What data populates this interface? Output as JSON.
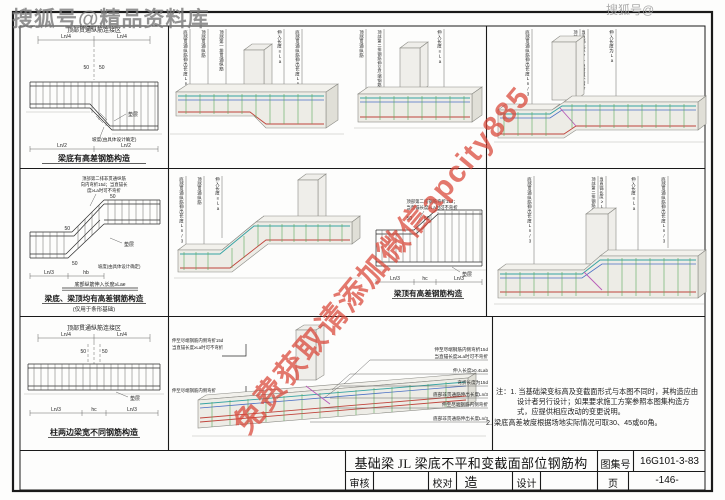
{
  "watermarks": {
    "top_left": "搜狐号@精品资料库",
    "top_right": "搜狐号@",
    "diagonal": "免费获取请添加微信apcity885"
  },
  "title_block": {
    "title": "基础梁 JL 梁底不平和变截面部位钢筋构造",
    "atlas_label": "图集号",
    "atlas_no": "16G101-3-83",
    "review_label": "审核",
    "check_label": "校对",
    "design_label": "设计",
    "page_label": "页",
    "page_no": "-146-"
  },
  "notes": {
    "prefix": "注：",
    "item1": "1. 当基础梁变标高及变截面形式与本图不同时，其构造应由设计者另行设计；如果要求施工方案参照本图集构造方式，应提供相应改动的变更说明。",
    "item2": "2. 梁底高差坡度根据场地实际情况可取30、45或60角。"
  },
  "p1": {
    "zone": "顶部贯通纵筋连接区",
    "ln4a": "Ln/4",
    "ln4b": "Ln/4",
    "f50a": "50",
    "f50b": "50",
    "cushion": "垫层",
    "slope_note": "坡度(由具体设计确定)",
    "dim1": "Ln/2",
    "dim2": "Ln/2",
    "caption": "梁底有高差钢筋构造"
  },
  "p2": {
    "note1": "顶部第二排非贯通纵筋",
    "note2": "向内弯折15d；当直锚长",
    "note3": "度≥La时可不弯折",
    "f50a": "50",
    "f50b": "50",
    "f50c": "50",
    "cushion": "垫层",
    "slope_note": "坡度(由具体设计确定)",
    "anchor": "底部纵筋伸入长度≥Lae",
    "dim1": "Ln/3",
    "dim2": "hb",
    "caption": "梁底、梁顶均有高差钢筋构造",
    "subcaption": "(仅用于条形基础)"
  },
  "p3": {
    "zone": "顶部贯通纵筋连接区",
    "ln4a": "Ln/4",
    "ln4b": "Ln/4",
    "f50a": "50",
    "f50b": "50",
    "cushion": "垫层",
    "dim1": "Ln/3",
    "dim2": "hc",
    "dim3": "Ln/3",
    "caption": "柱两边梁宽不同钢筋构造"
  },
  "p4": {
    "note1": "顶部第二排钢筋弯折15d；",
    "note2": "当直锚长度≥La时可不弯折",
    "f50a": "50",
    "f50b": "50",
    "cushion": "垫层",
    "dim1": "Ln/3",
    "dim2": "hc",
    "dim3": "Ln/3",
    "caption": "梁顶有高差钢筋构造"
  },
  "v1": {
    "l1": "底部贯通纵筋伸出长度Ln/3",
    "l2": "顶部贯通纵筋",
    "l3": "顶部第一排贯通纵筋",
    "l4": "伸入长度≥La",
    "l5": "底部贯通纵筋伸出长度Ln/3"
  },
  "v2": {
    "l1": "顶部贯通纵筋",
    "l2": "顶部第二排钢筋伸至尽端钢筋内侧",
    "l3": "伸入长度≥La"
  },
  "v3": {
    "l1": "底部贯通纵筋伸出长度Ln/3",
    "l2": "顶部第二排钢筋伸至尽端钢筋内侧弯折15d",
    "l3": "当直锚长度≥La时可不弯折",
    "l4": "伸入长度为La"
  },
  "v4": {
    "l1": "底部贯通纵筋伸出长度Ln/3",
    "l2": "顶部贯通纵筋",
    "l3": "伸入长度≥La"
  },
  "v5": {
    "l1": "底部贯通纵筋伸出长度Ln/3",
    "l2": "顶部第二排钢筋伸至尽端钢筋内侧弯折15d",
    "l3": "当直锚长度≥La时可不弯折",
    "l4": "伸入长度≥La",
    "l5": "底部贯通纵筋伸出长度Ln/3"
  },
  "v6": {
    "d1a": "伸至尽端钢筋内侧弯折15d",
    "d1b": "当直锚长度≥La时可不弯折",
    "d2": "伸至尽端钢筋内侧弯折",
    "l1a": "伸至尽端钢筋内侧弯折15d",
    "l1b": "当直锚长度≥La时可不弯折",
    "l2": "伸入长度≥0.4Lab",
    "l3": "弯折长度为15d",
    "l4": "底部非贯通筋伸出长度Ln/3",
    "l5": "伸至尽端钢筋内侧弯折",
    "l6": "底部非贯通筋伸出长度Ln/3"
  },
  "colors": {
    "rebar_red": "#c0443c",
    "rebar_teal": "#35a3a3",
    "rebar_blue": "#4a6fc4",
    "rebar_green": "#5aa85a",
    "rebar_magenta": "#b85ab8",
    "watermark_red": "#d84436",
    "watermark_gray": "#8f8f8f"
  }
}
